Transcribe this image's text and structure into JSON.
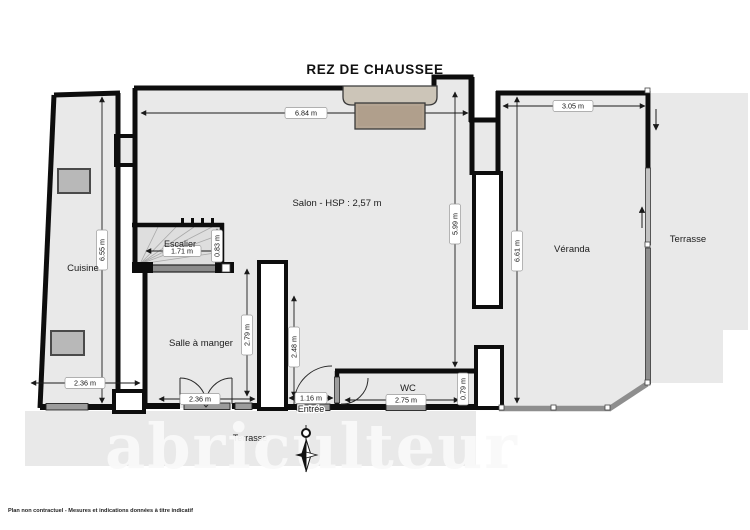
{
  "title": "REZ DE CHAUSSEE",
  "rooms": {
    "cuisine": "Cuisine",
    "escalier": "Escalier",
    "salon": "Salon - HSP : 2,57 m",
    "salle_a_manger": "Salle à manger",
    "entree": "Entrée",
    "wc": "WC",
    "veranda": "Véranda",
    "terrasse_droite": "Terrasse",
    "terrasse_bas": "Terrasse"
  },
  "dimensions": {
    "salon_largeur": "6.84 m",
    "veranda_largeur": "3.05 m",
    "cuisine_hauteur": "6.55 m",
    "escalier_largeur": "1.71 m",
    "escalier_profondeur": "0.83 m",
    "cuisine_largeur": "2.36 m",
    "salle_hauteur": "2.79 m",
    "salle_largeur": "2.36 m",
    "entree_hauteur": "2.48 m",
    "entree_largeur": "1.16 m",
    "wc_largeur": "2.75 m",
    "wc_hauteur": "0.79 m",
    "salon_hauteur": "5.99 m",
    "veranda_hauteur": "6.61 m"
  },
  "watermark": "abriculteur",
  "disclaimer": "Plan non contractuel - Mesures et indications données à titre indicatif",
  "colors": {
    "floor": "#e9e9e9",
    "wall": "#0d0d0d",
    "glass": "#8e8e8e",
    "mantel": "#ccc5b8",
    "firebox": "#b4a492"
  }
}
